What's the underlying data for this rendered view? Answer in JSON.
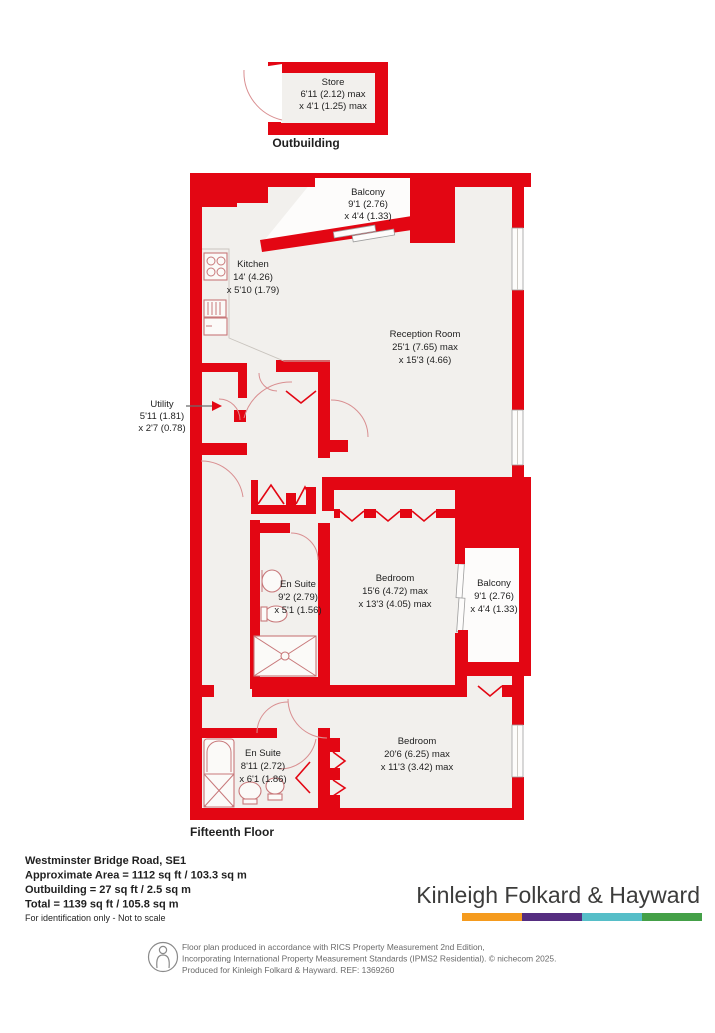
{
  "outbuilding": {
    "label": "Outbuilding",
    "store": {
      "name": "Store",
      "dim1": "6'11 (2.12) max",
      "dim2": "x 4'1 (1.25) max"
    }
  },
  "floor_label": "Fifteenth Floor",
  "rooms": {
    "balcony_top": {
      "name": "Balcony",
      "dim1": "9'1 (2.76)",
      "dim2": "x 4'4 (1.33)"
    },
    "kitchen": {
      "name": "Kitchen",
      "dim1": "14' (4.26)",
      "dim2": "x 5'10 (1.79)"
    },
    "reception": {
      "name": "Reception Room",
      "dim1": "25'1 (7.65) max",
      "dim2": "x 15'3 (4.66)"
    },
    "utility": {
      "name": "Utility",
      "dim1": "5'11 (1.81)",
      "dim2": "x 2'7 (0.78)"
    },
    "ensuite_mid": {
      "name": "En Suite",
      "dim1": "9'2 (2.79)",
      "dim2": "x 5'1 (1.56)"
    },
    "bedroom_mid": {
      "name": "Bedroom",
      "dim1": "15'6 (4.72) max",
      "dim2": "x 13'3 (4.05) max"
    },
    "balcony_right": {
      "name": "Balcony",
      "dim1": "9'1 (2.76)",
      "dim2": "x 4'4 (1.33)"
    },
    "ensuite_bottom": {
      "name": "En Suite",
      "dim1": "8'11 (2.72)",
      "dim2": "x 6'1 (1.86)"
    },
    "bedroom_bottom": {
      "name": "Bedroom",
      "dim1": "20'6 (6.25) max",
      "dim2": "x 11'3 (3.42) max"
    }
  },
  "summary": {
    "address": "Westminster Bridge Road, SE1",
    "approximate_area": "Approximate Area = 1112 sq ft / 103.3 sq m",
    "outbuilding_area": "Outbuilding = 27 sq ft / 2.5 sq m",
    "total_area": "Total = 1139 sq ft / 105.8 sq m",
    "note": "For identification only - Not to scale"
  },
  "branding": {
    "agent_name": "Kinleigh Folkard & Hayward",
    "bar_colors": [
      "#F59B1E",
      "#552D80",
      "#56BEC8",
      "#44A048"
    ]
  },
  "disclaimer": {
    "line1": "Floor plan produced in accordance with RICS Property Measurement 2nd Edition,",
    "line2": "Incorporating International Property Measurement Standards (IPMS2 Residential).   © nichecom 2025.",
    "line3": "Produced for Kinleigh Folkard & Hayward.   REF: 1369260"
  },
  "colors": {
    "wall": "#E30613",
    "floor": "#F2F0ED"
  }
}
